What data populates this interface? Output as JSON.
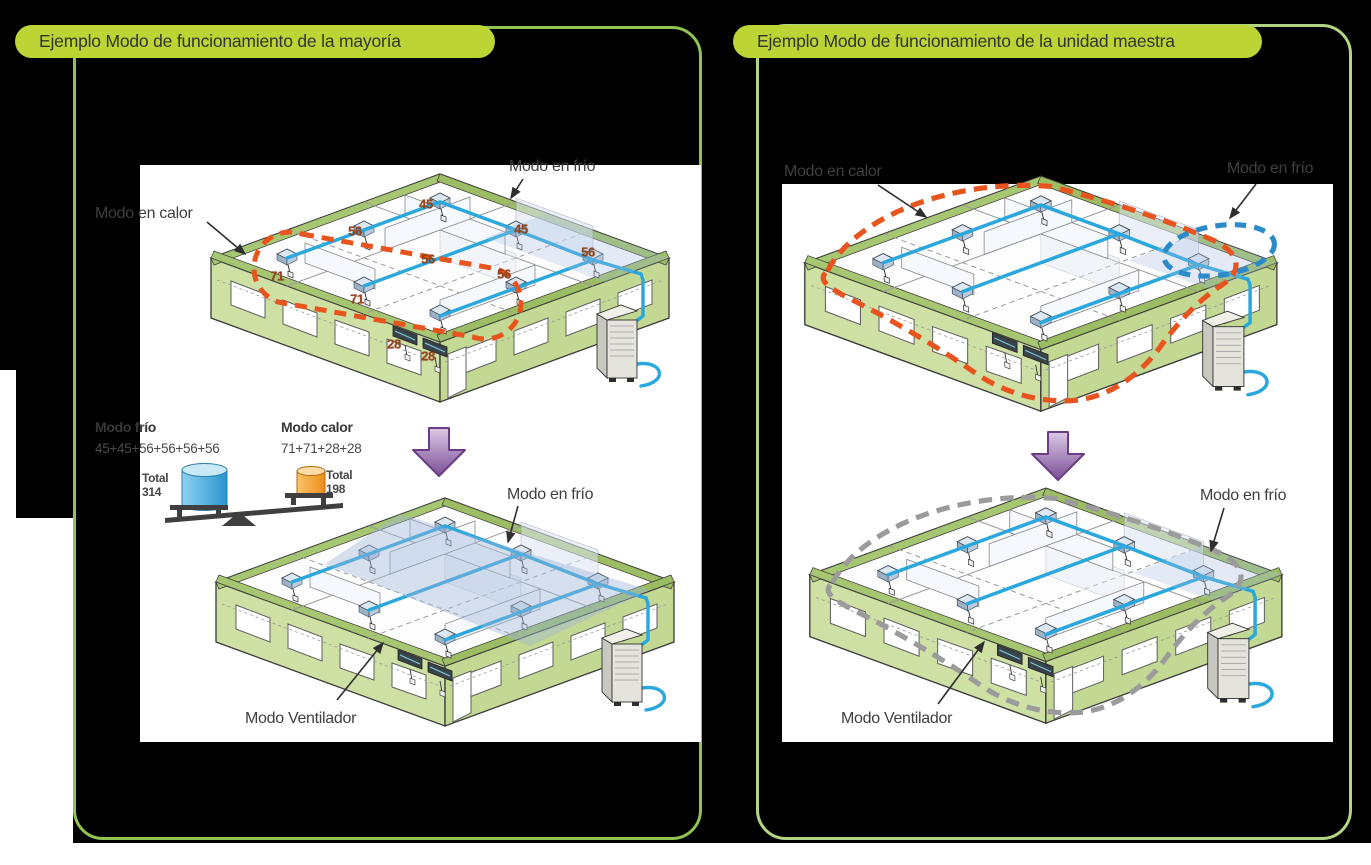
{
  "colors": {
    "background": "#000000",
    "panel_border_left": "#8fc352",
    "panel_border_right": "#b2d584",
    "header_pill": "#bcd434",
    "pipe_blue": "#2aa7dc",
    "heat_dash_orange": "#e8541e",
    "cool_dash_blue": "#2b8ac9",
    "fan_dash_gray": "#9b9b9b",
    "transition_arrow_purple": "#7b4f96",
    "cool_cylinder_blue": "#2894cc",
    "heat_cylinder_orange": "#ee8d1a",
    "load_number_brown": "#96451a",
    "building_wall_green": "#cfe0a4"
  },
  "left_section": {
    "header": "Ejemplo Modo de funcionamiento de la mayoría",
    "top_diagram": {
      "cool_label": "Modo en frío",
      "heat_label": "Modo en calor",
      "unit_loads": [
        "45",
        "56",
        "45",
        "56",
        "56",
        "56",
        "71",
        "71",
        "28",
        "28"
      ]
    },
    "balance": {
      "cool_title": "Modo frío",
      "cool_sum": "45+45+56+56+56+56",
      "cool_total": "Total\n314",
      "heat_title": "Modo calor",
      "heat_sum": "71+71+28+28",
      "heat_total": "Total\n198"
    },
    "bottom_diagram": {
      "cool_label": "Modo en frío",
      "fan_label": "Modo Ventilador"
    }
  },
  "right_section": {
    "header": "Ejemplo Modo de funcionamiento de la unidad maestra",
    "top_diagram": {
      "heat_label": "Modo en calor",
      "cool_label": "Modo en frío"
    },
    "bottom_diagram": {
      "cool_label": "Modo en frío",
      "fan_label": "Modo Ventilador"
    }
  }
}
